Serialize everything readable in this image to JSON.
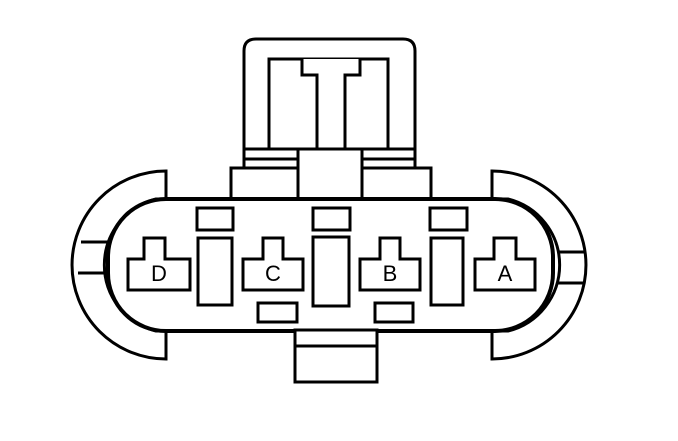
{
  "connector": {
    "terminals": [
      {
        "label": "D"
      },
      {
        "label": "C"
      },
      {
        "label": "B"
      },
      {
        "label": "A"
      }
    ]
  },
  "colors": {
    "line": "#000000",
    "background": "#ffffff"
  }
}
